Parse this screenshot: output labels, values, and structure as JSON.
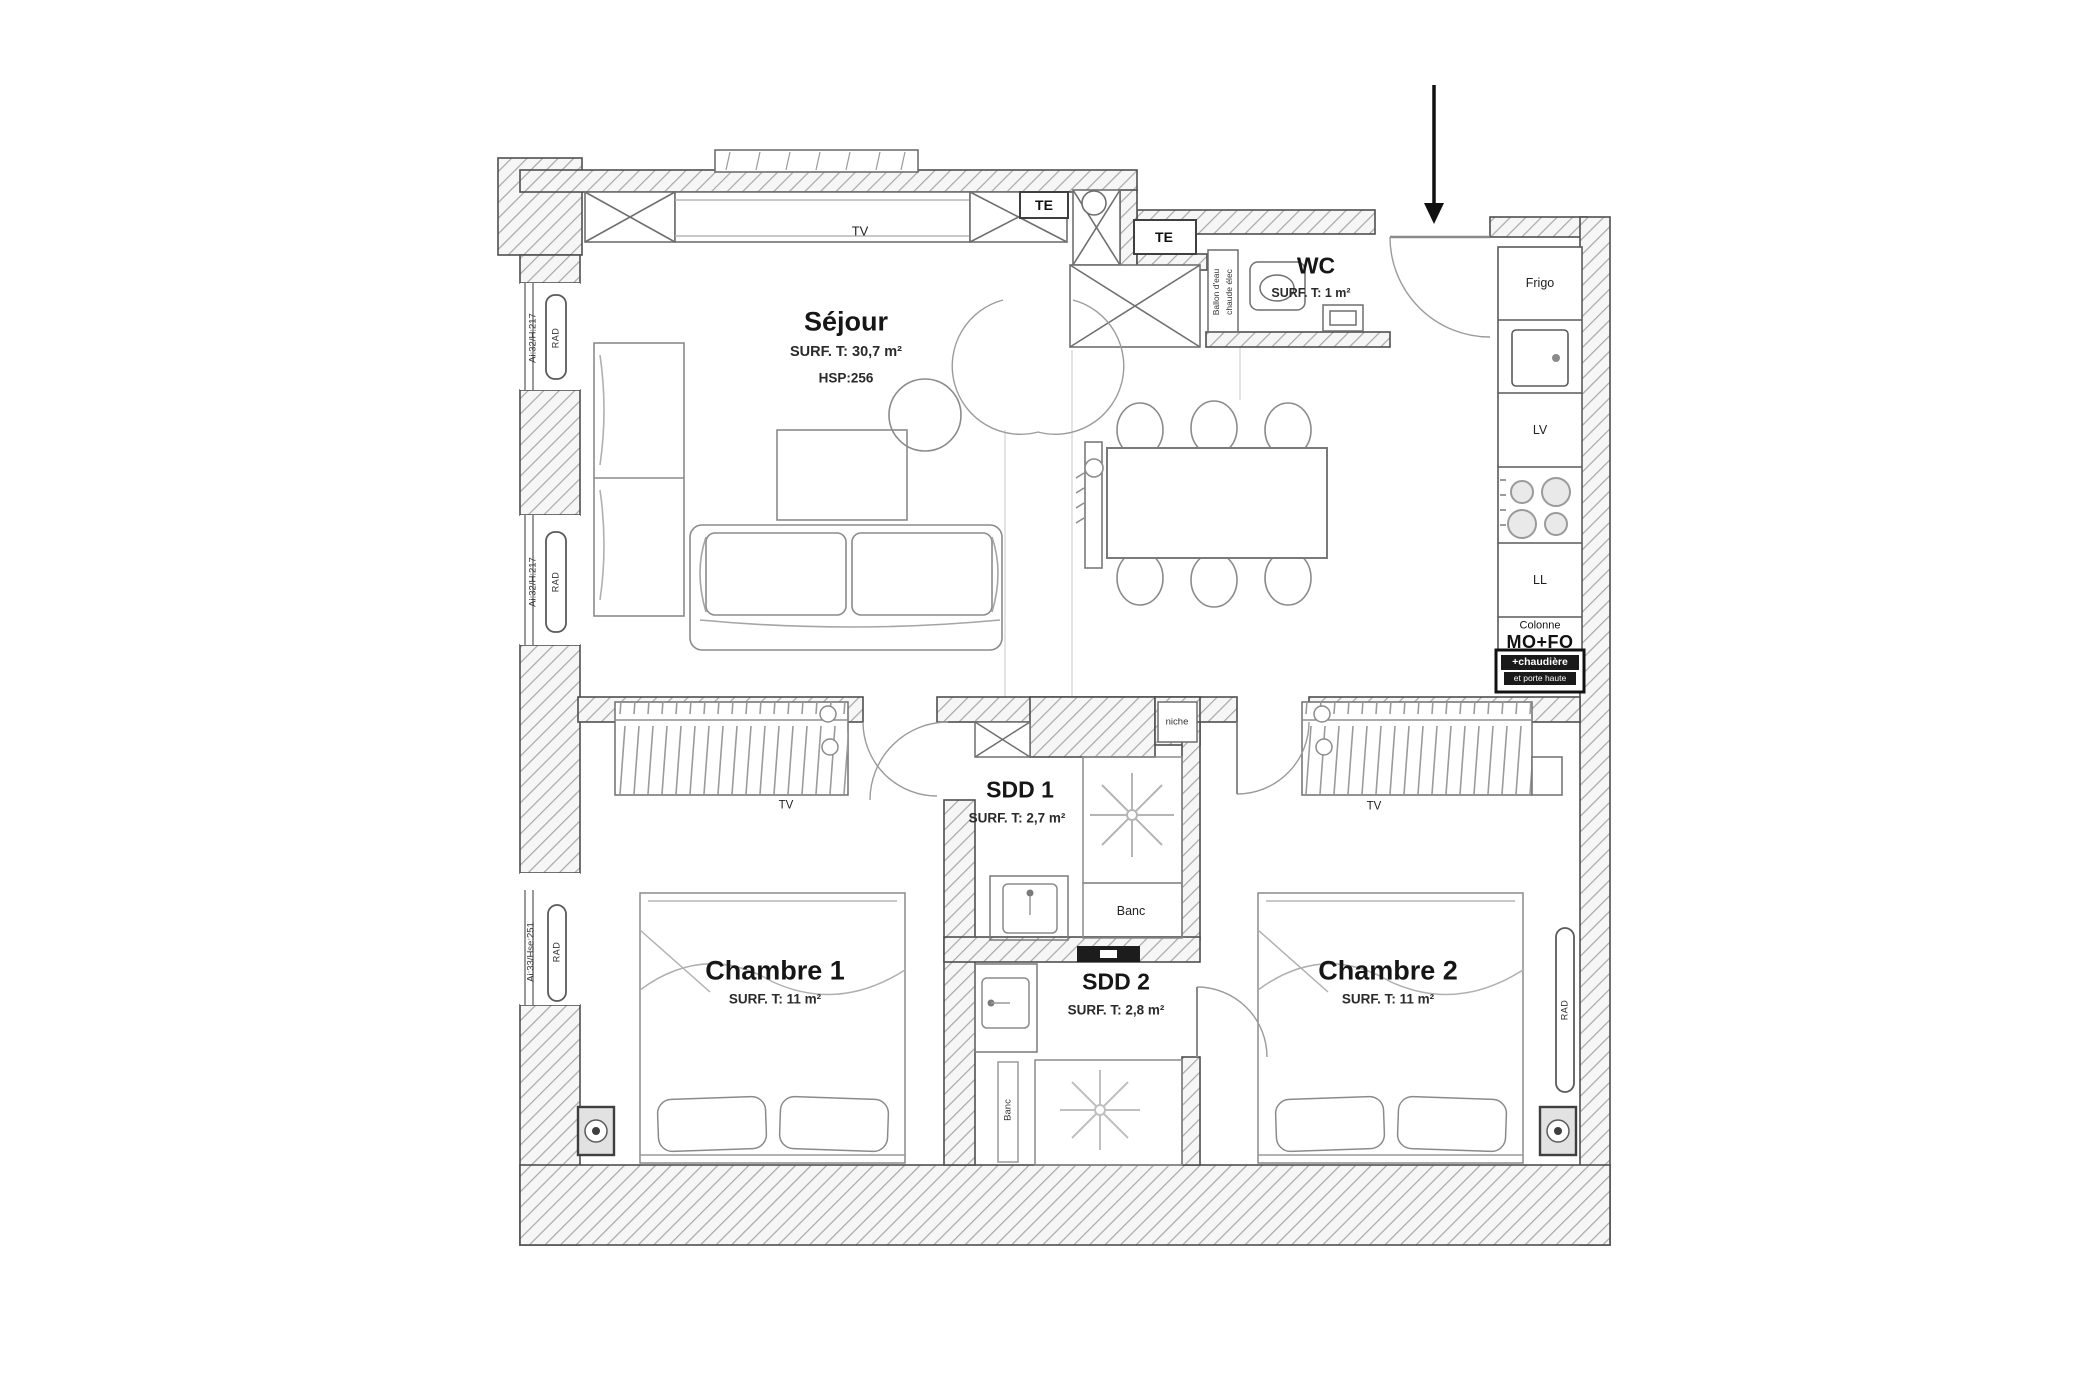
{
  "rooms": {
    "sejour": {
      "name": "Séjour",
      "surface": "SURF. T: 30,7 m²",
      "height": "HSP:256"
    },
    "wc": {
      "name": "WC",
      "surface": "SURF. T: 1 m²"
    },
    "sdd1": {
      "name": "SDD 1",
      "surface": "SURF. T: 2,7 m²"
    },
    "sdd2": {
      "name": "SDD 2",
      "surface": "SURF. T: 2,8 m²"
    },
    "chambre1": {
      "name": "Chambre 1",
      "surface": "SURF. T: 11 m²"
    },
    "chambre2": {
      "name": "Chambre 2",
      "surface": "SURF. T: 11 m²"
    }
  },
  "kitchen": {
    "frigo": "Frigo",
    "lave_vaisselle": "LV",
    "lave_linge": "LL",
    "colonne": "Colonne",
    "mo_fo": "MO+FO",
    "chaudiere": "+chaudière",
    "porte_haute": "et porte haute"
  },
  "annotations": {
    "tv": "TV",
    "te": "TE",
    "rad": "RAD",
    "niche": "niche",
    "banc": "Banc",
    "ballon_line1": "Ballon d'eau",
    "ballon_line2": "chaude élec"
  },
  "windows": {
    "w_top": "Ai:32/H:217",
    "w_mid": "Ai:32/H:217",
    "w_bottom": "Ai:33/Hse:251"
  },
  "colors": {
    "wall_line": "#4f4f4f",
    "hatch_line": "#a0a0a0",
    "furniture_line": "#8b8b8b",
    "text": "#1c1c1c",
    "arrow": "#111111"
  }
}
